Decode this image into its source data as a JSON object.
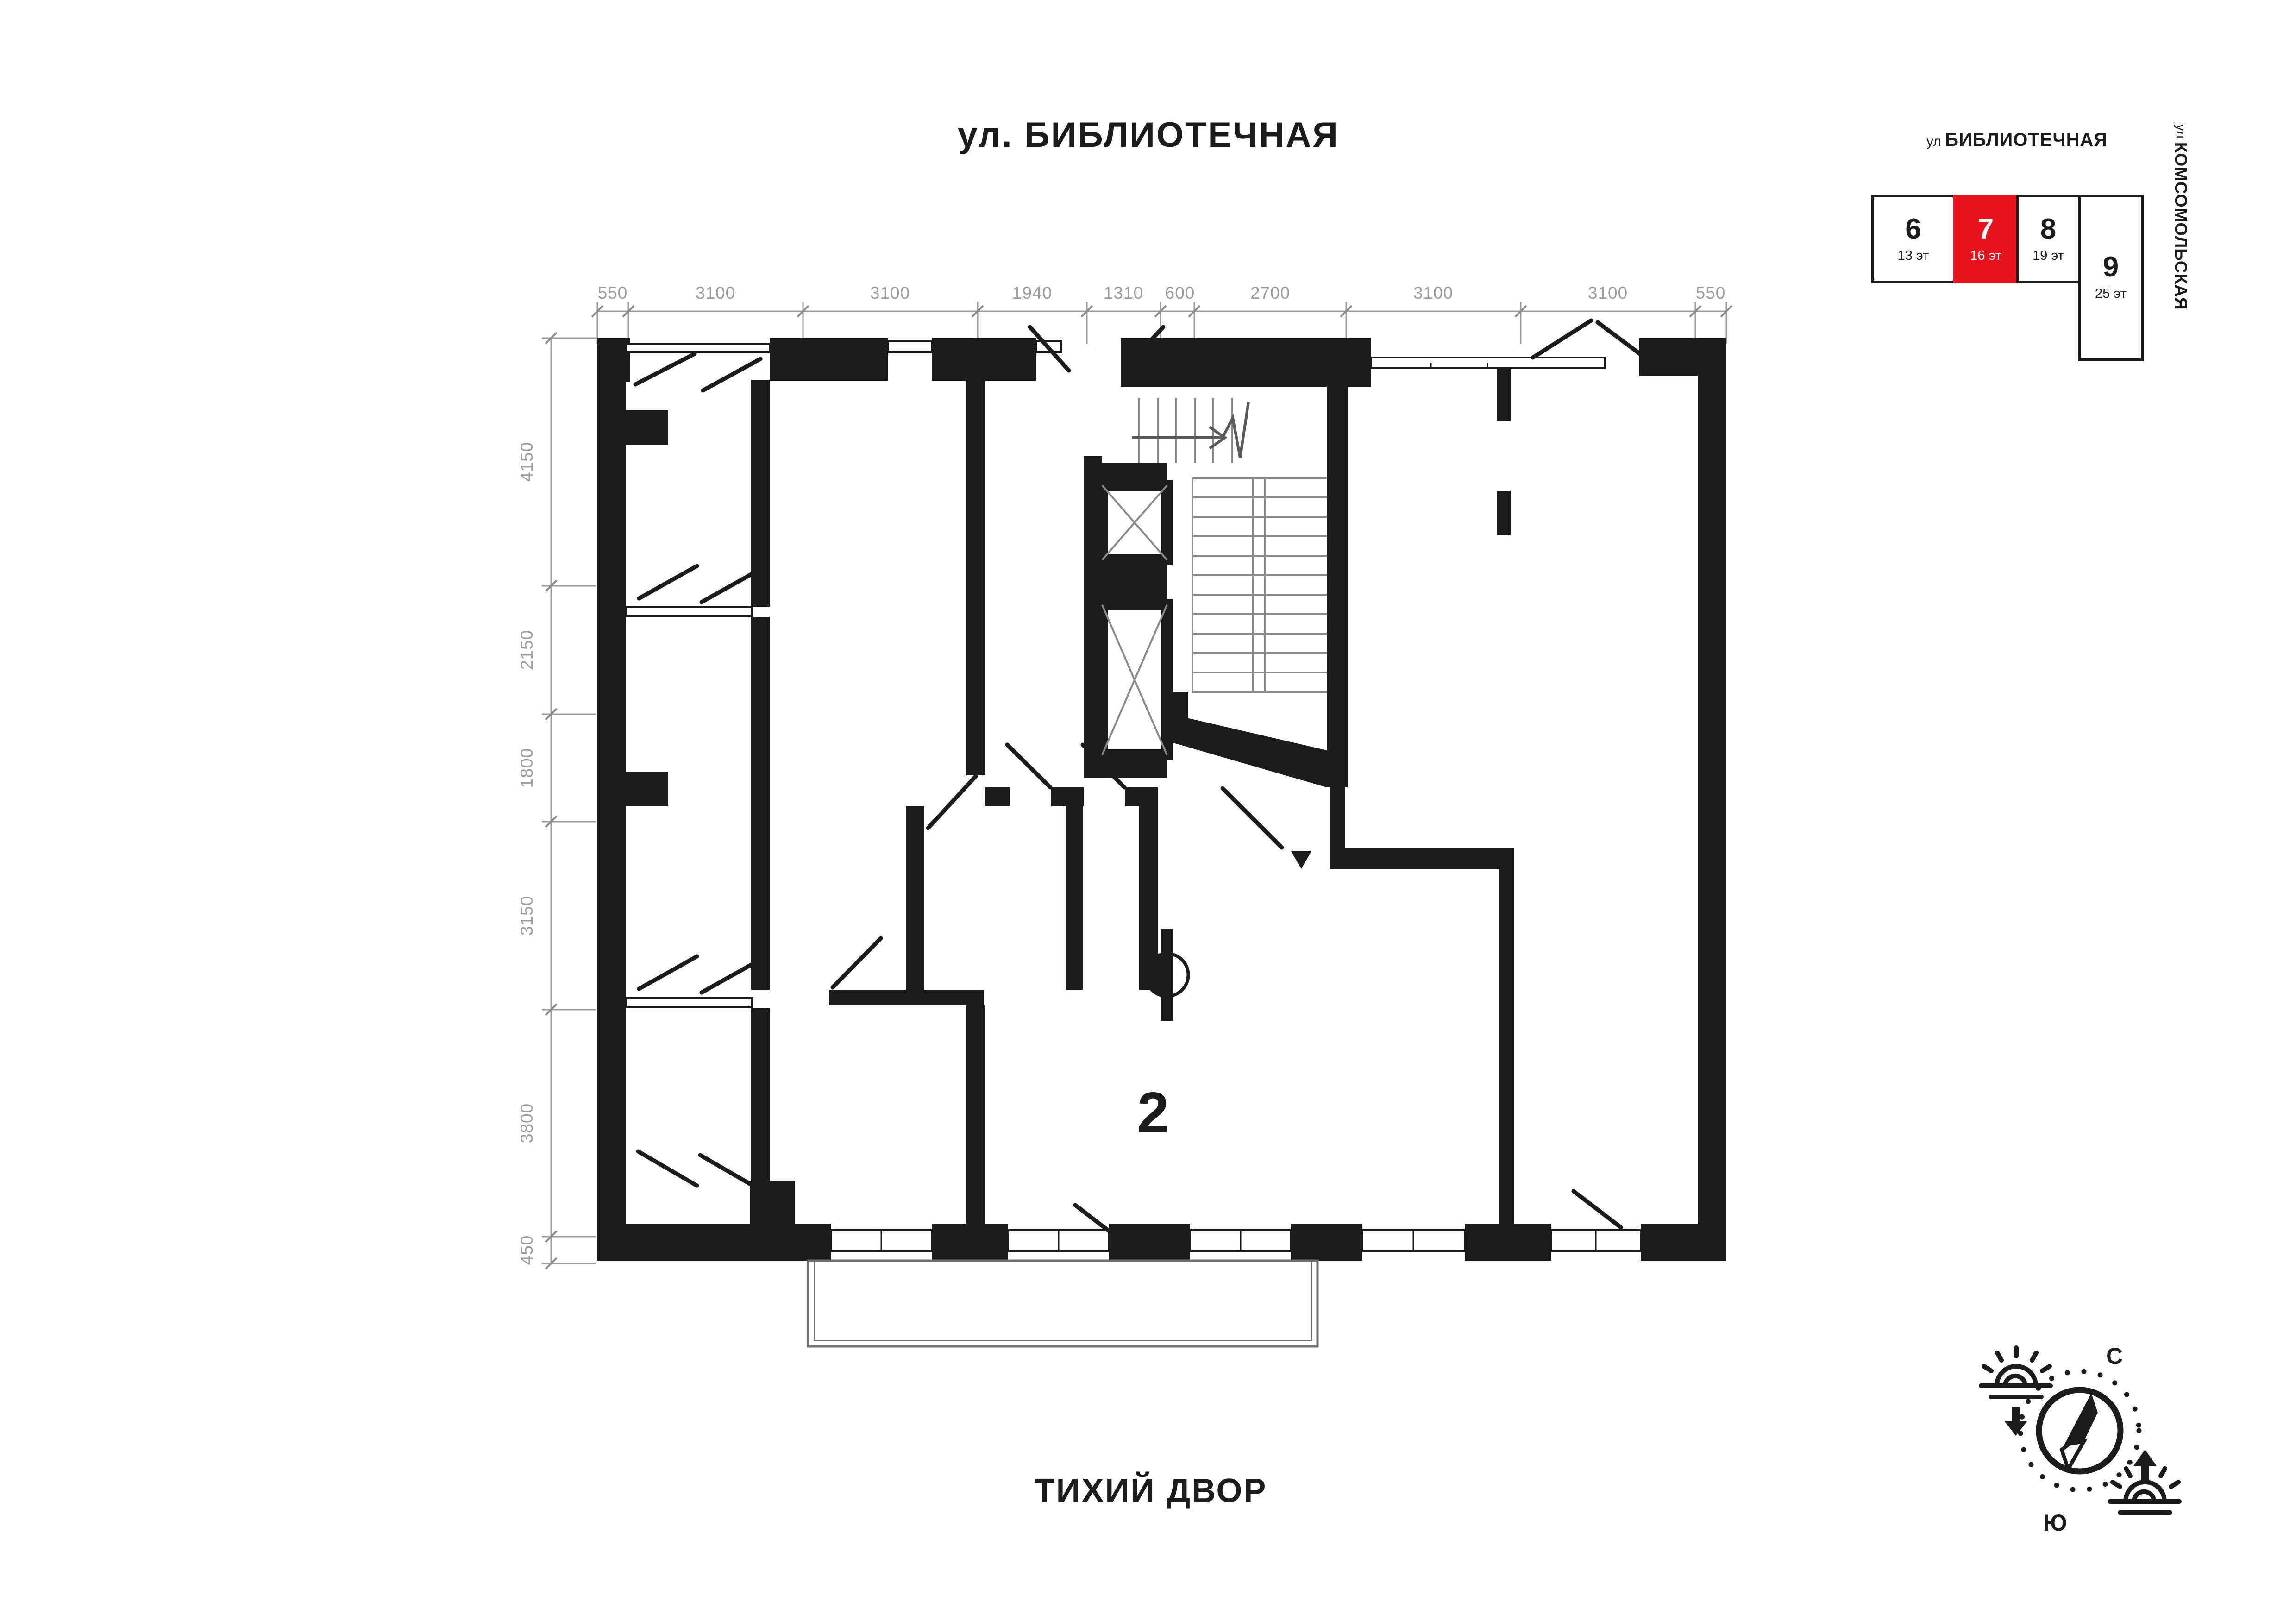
{
  "page": {
    "street_top_label": "ул. БИБЛИОТЕЧНАЯ",
    "courtyard_label": "ТИХИЙ ДВОР"
  },
  "plan": {
    "apartment_number": "2",
    "dims_top": [
      "550",
      "3100",
      "3100",
      "1940",
      "1310",
      "600",
      "2700",
      "3100",
      "3100",
      "550"
    ],
    "dims_left": [
      "4150",
      "2150",
      "1800",
      "3150",
      "3800",
      "450"
    ]
  },
  "minimap": {
    "street_top_prefix": "ул ",
    "street_top_name": "БИБЛИОТЕЧНАЯ",
    "street_right_prefix": "ул ",
    "street_right_name": "КОМСОМОЛЬСКАЯ",
    "buildings": [
      {
        "number": "6",
        "floors": "13 эт",
        "highlighted": false
      },
      {
        "number": "7",
        "floors": "16 эт",
        "highlighted": true
      },
      {
        "number": "8",
        "floors": "19 эт",
        "highlighted": false
      },
      {
        "number": "9",
        "floors": "25 эт",
        "highlighted": false
      }
    ],
    "highlight_color": "#e8131d"
  },
  "compass": {
    "north": "С",
    "south": "Ю"
  },
  "colors": {
    "wall": "#1c1c1e",
    "dim_line": "#9b9b9b",
    "highlight": "#e8131d",
    "shaft_cross": "#8a8a8a"
  }
}
